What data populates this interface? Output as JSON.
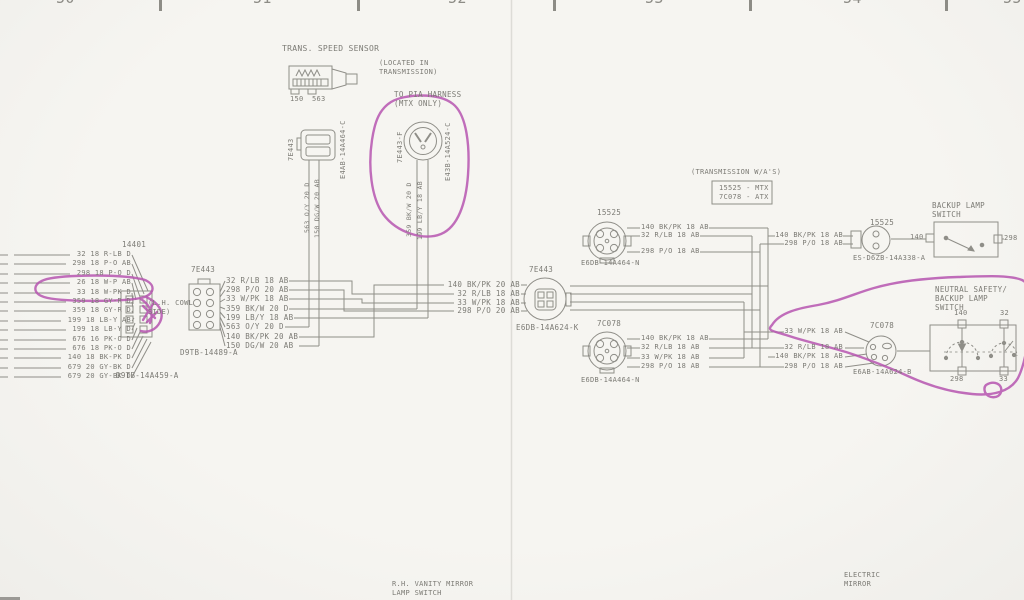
{
  "colors": {
    "background": "#f4f3ef",
    "ink": "#8f8e88",
    "text": "#7c7b75",
    "annotation": "#b655b0"
  },
  "ruler": {
    "numbers": [
      "50",
      "51",
      "52",
      "53",
      "54",
      "55"
    ]
  },
  "labels": [
    {
      "n": "ruler-number-50",
      "t": "50",
      "x": 56,
      "y": -9,
      "fs": 15,
      "c": "#8d8c86"
    },
    {
      "n": "ruler-number-51",
      "t": "51",
      "x": 253,
      "y": -9,
      "fs": 15,
      "c": "#8d8c86"
    },
    {
      "n": "ruler-number-52",
      "t": "52",
      "x": 448,
      "y": -9,
      "fs": 15,
      "c": "#8d8c86"
    },
    {
      "n": "ruler-number-53",
      "t": "53",
      "x": 645,
      "y": -9,
      "fs": 15,
      "c": "#8d8c86"
    },
    {
      "n": "ruler-number-54",
      "t": "54",
      "x": 843,
      "y": -9,
      "fs": 15,
      "c": "#8d8c86"
    },
    {
      "n": "ruler-number-55",
      "t": "55",
      "x": 1003,
      "y": -9,
      "fs": 15,
      "c": "#8d8c86"
    },
    {
      "n": "trans-speed-sensor-title",
      "t": "TRANS. SPEED SENSOR",
      "x": 282,
      "y": 45,
      "fs": 8
    },
    {
      "n": "sensor-pin-150",
      "t": "150",
      "x": 290,
      "y": 96,
      "fs": 7
    },
    {
      "n": "sensor-pin-563",
      "t": "563",
      "x": 312,
      "y": 96,
      "fs": 7
    },
    {
      "n": "located-note-line1",
      "t": "(LOCATED IN",
      "x": 379,
      "y": 60,
      "fs": 7
    },
    {
      "n": "located-note-line2",
      "t": "TRANSMISSION)",
      "x": 379,
      "y": 69,
      "fs": 7
    },
    {
      "n": "pia-note-line1",
      "t": "TO PIA HARNESS",
      "x": 394,
      "y": 91,
      "fs": 7.5
    },
    {
      "n": "pia-note-line2",
      "t": "(MTX ONLY)",
      "x": 394,
      "y": 100,
      "fs": 7.5
    },
    {
      "n": "connector-7e443a-label",
      "t": "7E443",
      "v": 1,
      "x": 288,
      "y": 161,
      "fs": 7
    },
    {
      "n": "connector-7e443a-part",
      "t": "E4AB-14A464-C",
      "v": 1,
      "x": 340,
      "y": 179,
      "fs": 7
    },
    {
      "n": "wire-563-vertical",
      "t": "563 O/Y 20 D",
      "v": 1,
      "x": 304,
      "y": 233,
      "fs": 6.5
    },
    {
      "n": "wire-150-vertical",
      "t": "150 DG/W 20 AB",
      "v": 1,
      "x": 314,
      "y": 238,
      "fs": 6.5
    },
    {
      "n": "connector-7e443f-label",
      "t": "7E443-F",
      "v": 1,
      "x": 397,
      "y": 163,
      "fs": 7
    },
    {
      "n": "connector-7e443f-part",
      "t": "E43B-14A524-C",
      "v": 1,
      "x": 445,
      "y": 181,
      "fs": 7
    },
    {
      "n": "wire-359-vertical",
      "t": "359 BK/W 20 D",
      "v": 1,
      "x": 406,
      "y": 237,
      "fs": 6.5
    },
    {
      "n": "wire-199-vertical",
      "t": "199 LB/Y 18 AB",
      "v": 1,
      "x": 417,
      "y": 240,
      "fs": 6.5
    },
    {
      "n": "cowl-wire-1",
      "t": "32 18 R-LB D",
      "x": 35,
      "y": 251,
      "fs": 7,
      "w": 96
    },
    {
      "n": "cowl-wire-2",
      "t": "298 18 P-O AB",
      "x": 35,
      "y": 260,
      "fs": 7,
      "w": 96
    },
    {
      "n": "cowl-wire-3",
      "t": "298 18 P-O D",
      "x": 35,
      "y": 270,
      "fs": 7,
      "w": 96
    },
    {
      "n": "cowl-wire-4",
      "t": "26 18 W-P AB",
      "x": 35,
      "y": 279,
      "fs": 7,
      "w": 96
    },
    {
      "n": "cowl-wire-5",
      "t": "33 18 W-PK D",
      "x": 35,
      "y": 289,
      "fs": 7,
      "w": 96
    },
    {
      "n": "cowl-wire-6",
      "t": "359 18 GY-R D",
      "x": 35,
      "y": 298,
      "fs": 7,
      "w": 96
    },
    {
      "n": "cowl-wire-7",
      "t": "359 18 GY-R D",
      "x": 35,
      "y": 307,
      "fs": 7,
      "w": 96
    },
    {
      "n": "cowl-wire-8",
      "t": "199 18 LB-Y AB",
      "x": 35,
      "y": 317,
      "fs": 7,
      "w": 96
    },
    {
      "n": "cowl-wire-9",
      "t": "199 18 LB-Y D",
      "x": 35,
      "y": 326,
      "fs": 7,
      "w": 96
    },
    {
      "n": "cowl-wire-10",
      "t": "676 16 PK-O D",
      "x": 35,
      "y": 336,
      "fs": 7,
      "w": 96
    },
    {
      "n": "cowl-wire-11",
      "t": "676 18 PK-O D",
      "x": 35,
      "y": 345,
      "fs": 7,
      "w": 96
    },
    {
      "n": "cowl-wire-12",
      "t": "140 18 BK-PK D",
      "x": 35,
      "y": 354,
      "fs": 7,
      "w": 96
    },
    {
      "n": "cowl-wire-13",
      "t": "679 20 GY-BK D",
      "x": 35,
      "y": 364,
      "fs": 7,
      "w": 96
    },
    {
      "n": "cowl-wire-14",
      "t": "679 20 GY-BK D",
      "x": 35,
      "y": 373,
      "fs": 7,
      "w": 96
    },
    {
      "n": "connector-14401-label",
      "t": "14401",
      "x": 122,
      "y": 241,
      "fs": 7.5
    },
    {
      "n": "cowl-side-note-line1",
      "t": "(L.H. COWL",
      "x": 148,
      "y": 300,
      "fs": 7
    },
    {
      "n": "cowl-side-note-line2",
      "t": "SIDE)",
      "x": 148,
      "y": 309,
      "fs": 7
    },
    {
      "n": "connector-14401-part",
      "t": "D9TB-14A459-A",
      "x": 116,
      "y": 372,
      "fs": 7.5
    },
    {
      "n": "connector-7e443b-label",
      "t": "7E443",
      "x": 191,
      "y": 266,
      "fs": 7.5
    },
    {
      "n": "harness-wire-1",
      "t": "32 R/LB 18 AB",
      "x": 226,
      "y": 277,
      "fs": 7.5
    },
    {
      "n": "harness-wire-2",
      "t": "298 P/O 20 AB",
      "x": 226,
      "y": 286,
      "fs": 7.5
    },
    {
      "n": "harness-wire-3",
      "t": "33 W/PK 18 AB",
      "x": 226,
      "y": 295,
      "fs": 7.5
    },
    {
      "n": "harness-wire-4",
      "t": "359 BK/W 20 D",
      "x": 226,
      "y": 305,
      "fs": 7.5
    },
    {
      "n": "harness-wire-5",
      "t": "199 LB/Y 18 AB",
      "x": 226,
      "y": 314,
      "fs": 7.5
    },
    {
      "n": "harness-wire-6",
      "t": "563 O/Y 20 D",
      "x": 226,
      "y": 323,
      "fs": 7.5
    },
    {
      "n": "harness-wire-7",
      "t": "140 BK/PK 20 AB",
      "x": 226,
      "y": 333,
      "fs": 7.5
    },
    {
      "n": "harness-wire-8",
      "t": "150 DG/W 20 AB",
      "x": 226,
      "y": 342,
      "fs": 7.5
    },
    {
      "n": "connector-7e443b-part",
      "t": "D9TB-14489-A",
      "x": 180,
      "y": 349,
      "fs": 7.5
    },
    {
      "n": "connector-7e443k-label",
      "t": "7E443",
      "x": 529,
      "y": 266,
      "fs": 7.5
    },
    {
      "n": "trunk-wire-1",
      "t": "140 BK/PK 20 AB",
      "x": 430,
      "y": 281,
      "fs": 7.5,
      "w": 90
    },
    {
      "n": "trunk-wire-2",
      "t": "32 R/LB 18 AB",
      "x": 430,
      "y": 290,
      "fs": 7.5,
      "w": 90
    },
    {
      "n": "trunk-wire-3",
      "t": "33 W/PK 18 AB",
      "x": 430,
      "y": 299,
      "fs": 7.5,
      "w": 90
    },
    {
      "n": "trunk-wire-4",
      "t": "298 P/O 20 AB",
      "x": 430,
      "y": 307,
      "fs": 7.5,
      "w": 90
    },
    {
      "n": "connector-7e443k-part",
      "t": "E6DB-14A624-K",
      "x": 516,
      "y": 324,
      "fs": 7.5
    },
    {
      "n": "transmission-wa-note",
      "t": "(TRANSMISSION W/A'S)",
      "x": 691,
      "y": 169,
      "fs": 7
    },
    {
      "n": "trans-box-mtx-row",
      "t": "15525 - MTX",
      "x": 719,
      "y": 185,
      "fs": 7
    },
    {
      "n": "trans-box-atx-row",
      "t": "7C078 - ATX",
      "x": 719,
      "y": 194,
      "fs": 7
    },
    {
      "n": "connector-15525-label",
      "t": "15525",
      "x": 597,
      "y": 209,
      "fs": 7.5
    },
    {
      "n": "mtx-wire-1",
      "t": "140 BK/PK 18 AB",
      "x": 641,
      "y": 224,
      "fs": 7
    },
    {
      "n": "mtx-wire-2",
      "t": "32 R/LB 18 AB",
      "x": 641,
      "y": 232,
      "fs": 7
    },
    {
      "n": "mtx-wire-3",
      "t": "298 P/O 18 AB",
      "x": 641,
      "y": 248,
      "fs": 7
    },
    {
      "n": "connector-15525-part",
      "t": "E6DB-14A464-N",
      "x": 581,
      "y": 260,
      "fs": 7
    },
    {
      "n": "mtx-inline-wire-1",
      "t": "140 BK/PK 18 AB",
      "x": 775,
      "y": 232,
      "fs": 7,
      "w": 68
    },
    {
      "n": "mtx-inline-wire-2",
      "t": "298 P/O 18 AB",
      "x": 775,
      "y": 240,
      "fs": 7,
      "w": 68
    },
    {
      "n": "connector-15525b-label",
      "t": "15525",
      "x": 870,
      "y": 219,
      "fs": 7.5
    },
    {
      "n": "connector-15525b-part",
      "t": "ES-D6ZB-14A338-A",
      "x": 853,
      "y": 255,
      "fs": 7
    },
    {
      "n": "backup-switch-title-line1",
      "t": "BACKUP LAMP",
      "x": 932,
      "y": 202,
      "fs": 7.5
    },
    {
      "n": "backup-switch-title-line2",
      "t": "SWITCH",
      "x": 932,
      "y": 211,
      "fs": 7.5
    },
    {
      "n": "backup-terminal-140",
      "t": "140",
      "x": 910,
      "y": 234,
      "fs": 7
    },
    {
      "n": "backup-terminal-298",
      "t": "298",
      "x": 1004,
      "y": 235,
      "fs": 7
    },
    {
      "n": "connector-7c078-label",
      "t": "7C078",
      "x": 597,
      "y": 320,
      "fs": 7.5
    },
    {
      "n": "atx-wire-1",
      "t": "140 BK/PK 18 AB",
      "x": 641,
      "y": 335,
      "fs": 7
    },
    {
      "n": "atx-wire-2",
      "t": "32 R/LB 18 AB",
      "x": 641,
      "y": 344,
      "fs": 7
    },
    {
      "n": "atx-wire-3",
      "t": "33 W/PK 18 AB",
      "x": 641,
      "y": 354,
      "fs": 7
    },
    {
      "n": "atx-wire-4",
      "t": "298 P/O 18 AB",
      "x": 641,
      "y": 363,
      "fs": 7
    },
    {
      "n": "connector-7c078-part",
      "t": "E6DB-14A464-N",
      "x": 581,
      "y": 377,
      "fs": 7
    },
    {
      "n": "atx-inline-wire-1",
      "t": "33 W/PK 18 AB",
      "x": 775,
      "y": 328,
      "fs": 7,
      "w": 68
    },
    {
      "n": "atx-inline-wire-2",
      "t": "32 R/LB 18 AB",
      "x": 775,
      "y": 344,
      "fs": 7,
      "w": 68
    },
    {
      "n": "atx-inline-wire-3",
      "t": "140 BK/PK 18 AB",
      "x": 775,
      "y": 353,
      "fs": 7,
      "w": 68
    },
    {
      "n": "atx-inline-wire-4",
      "t": "298 P/O 18 AB",
      "x": 775,
      "y": 363,
      "fs": 7,
      "w": 68
    },
    {
      "n": "connector-7c078b-label",
      "t": "7C078",
      "x": 870,
      "y": 322,
      "fs": 7.5
    },
    {
      "n": "connector-7c078b-part",
      "t": "E6AB-14A624-B",
      "x": 853,
      "y": 369,
      "fs": 7
    },
    {
      "n": "neutral-switch-title-line1",
      "t": "NEUTRAL SAFETY/",
      "x": 935,
      "y": 286,
      "fs": 7.5
    },
    {
      "n": "neutral-switch-title-line2",
      "t": "BACKUP LAMP",
      "x": 935,
      "y": 295,
      "fs": 7.5
    },
    {
      "n": "neutral-switch-title-line3",
      "t": "SWITCH",
      "x": 935,
      "y": 304,
      "fs": 7.5
    },
    {
      "n": "neutral-terminal-140",
      "t": "140",
      "x": 954,
      "y": 310,
      "fs": 7
    },
    {
      "n": "neutral-terminal-32",
      "t": "32",
      "x": 1000,
      "y": 310,
      "fs": 7
    },
    {
      "n": "neutral-terminal-298",
      "t": "298",
      "x": 950,
      "y": 376,
      "fs": 7
    },
    {
      "n": "neutral-terminal-33",
      "t": "33",
      "x": 999,
      "y": 376,
      "fs": 7
    },
    {
      "n": "vanity-mirror-label-line1",
      "t": "R.H. VANITY MIRROR",
      "x": 392,
      "y": 581,
      "fs": 7
    },
    {
      "n": "vanity-mirror-label-line2",
      "t": "LAMP SWITCH",
      "x": 392,
      "y": 590,
      "fs": 7
    },
    {
      "n": "electric-mirror-label-line1",
      "t": "ELECTRIC",
      "x": 844,
      "y": 572,
      "fs": 7
    },
    {
      "n": "electric-mirror-label-line2",
      "t": "MIRROR",
      "x": 844,
      "y": 581,
      "fs": 7
    }
  ]
}
